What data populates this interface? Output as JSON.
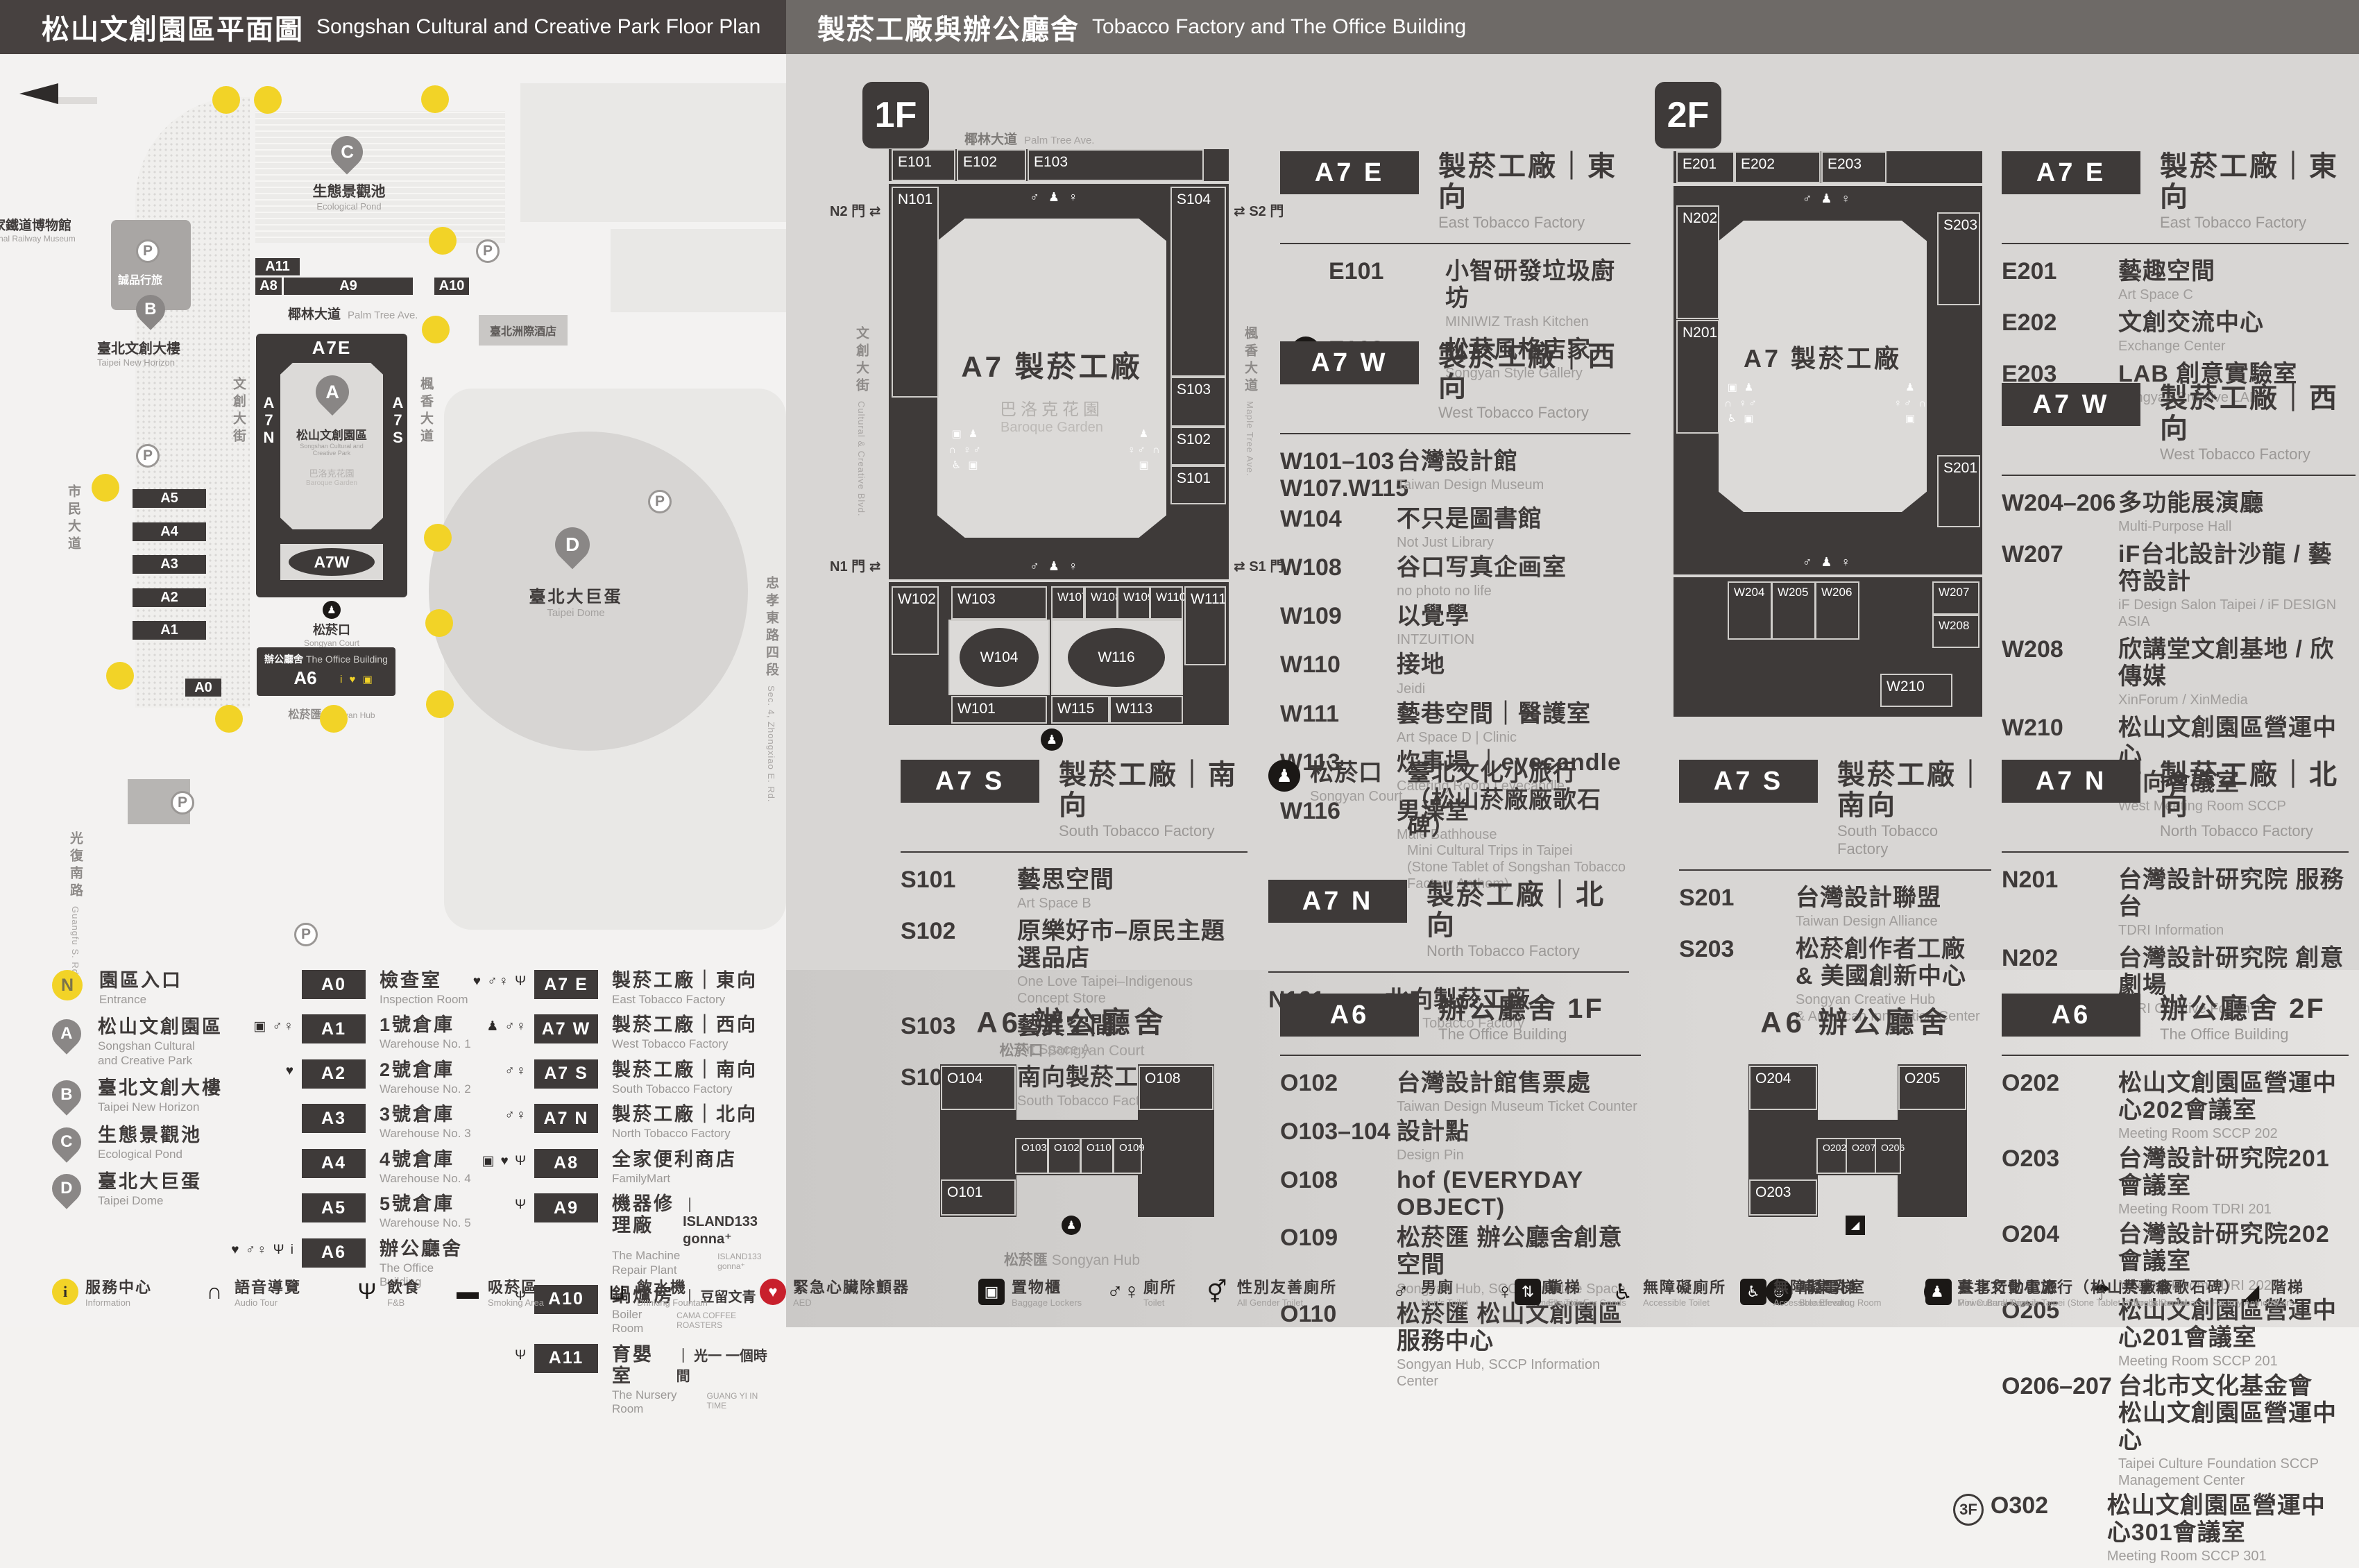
{
  "header": {
    "left_zh": "松山文創園區平面圖",
    "left_en": "Songshan Cultural and Creative Park Floor Plan",
    "right_zh": "製菸工廠與辦公廳舍",
    "right_en": "Tobacco Factory and The Office Building"
  },
  "floors": {
    "f1": "1F",
    "f2": "2F"
  },
  "plans": {
    "a6_title": "A6 辦公廳舍",
    "center_big": "A7 製菸工廠",
    "garden_zh": "巴洛克花園",
    "garden_en": "Baroque Garden",
    "palm_zh": "椰林大道",
    "palm_en": "Palm Tree Ave.",
    "ccblvd_zh": "文創大街",
    "ccblvd_en": "Cultural & Creative Blvd.",
    "maple_zh": "楓香大道",
    "maple_en": "Maple Tree Ave.",
    "court_zh": "松菸口",
    "court_en": "Songyan Court",
    "hub_zh": "松菸匯",
    "hub_en": "Songyan Hub",
    "gate_arrow": "⇄",
    "gate_n2": "N2 門",
    "gate_s2": "S2 門",
    "gate_n1": "N1 門",
    "gate_s1": "S1 門",
    "gate_icons": "♂ ♟ ♀",
    "wing_icons_l": "▣ ♟\n∩ ♀♂\n♿ ▣",
    "wing_icons_r": "♟\n♀♂ ∩\n▣",
    "trips_glyph": "♟",
    "fnb_glyph": "Ψ",
    "locker_glyph": "▣",
    "aed_glyph": "♥",
    "umb_glyph": "☂",
    "f1": [
      "E101",
      "E102",
      "E103",
      "N101",
      "S104",
      "S103",
      "S102",
      "S101",
      "W102",
      "W103",
      "W104",
      "W101",
      "W107",
      "W108",
      "W109",
      "W110",
      "W116",
      "W115",
      "W113",
      "W111"
    ],
    "f2": [
      "E201",
      "E202",
      "E203",
      "N202",
      "N201",
      "S203",
      "S201",
      "W204",
      "W205",
      "W206",
      "W207",
      "W208",
      "W210"
    ],
    "a6f1": [
      "O104",
      "O101",
      "O103",
      "O102",
      "O110",
      "O109",
      "O108"
    ],
    "a6f2": [
      "O204",
      "O203",
      "O202",
      "O207",
      "O206",
      "O205"
    ]
  },
  "dir": {
    "f1_e": {
      "badge": "A7 E",
      "zh": "製菸工廠｜東向",
      "en": "East Tobacco Factory",
      "items": [
        {
          "id": "E101",
          "zh": "小智研發垃圾廚坊",
          "en": "MINIWIZ Trash Kitchen"
        },
        {
          "icon": "Ψ",
          "id": "E103",
          "zh": "松菸風格店家",
          "en": "Songyan Style Gallery"
        }
      ]
    },
    "f1_w": {
      "badge": "A7 W",
      "zh": "製菸工廠｜西向",
      "en": "West Tobacco Factory",
      "items": [
        {
          "id": "W101–103\nW107.W115",
          "zh": "台灣設計館",
          "en": "Taiwan Design Museum"
        },
        {
          "id": "W104",
          "zh": "不只是圖書館",
          "en": "Not Just Library"
        },
        {
          "id": "W108",
          "zh": "谷口写真企画室",
          "en": "no photo no life"
        },
        {
          "id": "W109",
          "zh": "以覺學",
          "en": "INTZUITION"
        },
        {
          "id": "W110",
          "zh": "接地",
          "en": "Jeidi"
        },
        {
          "id": "W111",
          "zh": "藝巷空間｜醫護室",
          "en": "Art Space D | Clinic"
        },
        {
          "id": "W113",
          "zh": "炊事場 ｜eyecandle",
          "en": "Catering Room | eyecandle"
        },
        {
          "id": "W116",
          "zh": "男澡堂",
          "en": "Male Bathhouse"
        }
      ]
    },
    "f1_s": {
      "badge": "A7 S",
      "zh": "製菸工廠｜南向",
      "en": "South Tobacco Factory",
      "items": [
        {
          "id": "S101",
          "zh": "藝思空間",
          "en": "Art Space B"
        },
        {
          "id": "S102",
          "zh": "原樂好市–原民主題選品店",
          "en": "One Love Taipei–Indigenous Concept Store"
        },
        {
          "id": "S103",
          "zh": "藝異空間",
          "en": "Art Space A"
        },
        {
          "id": "S104",
          "zh": "南向製菸工廠",
          "en": "South Tobacco Factory"
        }
      ]
    },
    "court": {
      "icon": "♟",
      "zh": "松菸口",
      "en": "Songyan Court",
      "item_zh": "臺北文化小旅行\n（松山菸廠廠歌石碑）",
      "item_en": "Mini Cultural Trips in Taipei\n(Stone Tablet of Songshan Tobacco Factory Anthem)"
    },
    "f1_n": {
      "badge": "A7 N",
      "zh": "製菸工廠｜北向",
      "en": "North Tobacco Factory",
      "items": [
        {
          "id": "N101",
          "zh": "北向製菸工廠",
          "en": "North Tobacco Factory"
        }
      ]
    },
    "f1_a6": {
      "badge": "A6",
      "zh": "辦公廳舍 1F",
      "en": "The Office Building",
      "items": [
        {
          "id": "O102",
          "zh": "台灣設計館售票處",
          "en": "Taiwan Design Museum Ticket Counter"
        },
        {
          "id": "O103–104",
          "zh": "設計點",
          "en": "Design Pin"
        },
        {
          "id": "O108",
          "zh": "hof (EVERYDAY OBJECT)",
          "en": ""
        },
        {
          "id": "O109",
          "zh": "松菸匯 辦公廳舍創意空間",
          "en": "Songyan Hub, SCCP Creative Space"
        },
        {
          "id": "O110",
          "zh": "松菸匯 松山文創園區服務中心",
          "en": "Songyan Hub, SCCP Information Center"
        }
      ]
    },
    "f2_e": {
      "badge": "A7 E",
      "zh": "製菸工廠｜東向",
      "en": "East Tobacco Factory",
      "items": [
        {
          "id": "E201",
          "zh": "藝趣空間",
          "en": "Art Space C"
        },
        {
          "id": "E202",
          "zh": "文創交流中心",
          "en": "Exchange Center"
        },
        {
          "id": "E203",
          "zh": "LAB 創意實驗室",
          "en": "Songyan Creative LAB"
        }
      ]
    },
    "f2_w": {
      "badge": "A7 W",
      "zh": "製菸工廠｜西向",
      "en": "West Tobacco Factory",
      "items": [
        {
          "id": "W204–206",
          "zh": "多功能展演廳",
          "en": "Multi-Purpose Hall"
        },
        {
          "id": "W207",
          "zh": "iF台北設計沙龍 / 藝符設計",
          "en": "iF Design Salon Taipei / iF DESIGN ASIA"
        },
        {
          "id": "W208",
          "zh": "欣講堂文創基地 / 欣傳媒",
          "en": "XinForum / XinMedia"
        },
        {
          "id": "W210",
          "zh": "松山文創園區營運中心\n西向會議室",
          "en": "West Meeting Room SCCP"
        }
      ]
    },
    "f2_s": {
      "badge": "A7 S",
      "zh": "製菸工廠｜南向",
      "en": "South Tobacco Factory",
      "items": [
        {
          "id": "S201",
          "zh": "台灣設計聯盟",
          "en": "Taiwan Design Alliance"
        },
        {
          "id": "S203",
          "zh": "松菸創作者工廠\n& 美國創新中心",
          "en": "Songyan Creative Hub\n& American Innovation Center"
        }
      ]
    },
    "f2_n": {
      "badge": "A7 N",
      "zh": "製菸工廠｜北向",
      "en": "North Tobacco Factory",
      "items": [
        {
          "id": "N201",
          "zh": "台灣設計研究院 服務台",
          "en": "TDRI Information"
        },
        {
          "id": "N202",
          "zh": "台灣設計研究院 創意劇場",
          "en": "TDRI Creative Forum"
        }
      ]
    },
    "f2_a6": {
      "badge": "A6",
      "zh": "辦公廳舍 2F",
      "en": "The Office Building",
      "items": [
        {
          "id": "O202",
          "zh": "松山文創園區營運中心202會議室",
          "en": "Meeting Room SCCP 202"
        },
        {
          "id": "O203",
          "zh": "台灣設計研究院201會議室",
          "en": "Meeting Room TDRI 201"
        },
        {
          "id": "O204",
          "zh": "台灣設計研究院202會議室",
          "en": "Meeting Room TDRI 202"
        },
        {
          "id": "O205",
          "zh": "松山文創園區營運中心201會議室",
          "en": "Meeting Room SCCP 201"
        },
        {
          "id": "O206–207",
          "zh": "台北市文化基金會\n松山文創園區營運中心",
          "en": "Taipei Culture Foundation SCCP Management Center"
        },
        {
          "prefix": "3F",
          "id": "O302",
          "zh": "松山文創園區營運中心301會議室",
          "en": "Meeting Room SCCP 301"
        }
      ]
    }
  },
  "map": {
    "p": "P",
    "pins": {
      "a": "A",
      "b": "B",
      "c": "C",
      "d": "D"
    },
    "entrances": [
      {
        "n": "1"
      },
      {
        "n": "2"
      },
      {
        "n": "3"
      },
      {
        "n": "4"
      },
      {
        "n": "5"
      },
      {
        "n": "6"
      },
      {
        "n": "7"
      },
      {
        "n": "8"
      },
      {
        "n": "9"
      },
      {
        "n": "10"
      },
      {
        "n": "11"
      },
      {
        "n": "12"
      }
    ],
    "railway_zh": "國家鐵道博物館",
    "railway_en": "National Railway Museum",
    "pond_zh": "生態景觀池",
    "pond_en": "Ecological Pond",
    "horizon_zh": "臺北文創大樓",
    "horizon_en": "Taipei New Horizon",
    "eslite": "誠品行旅",
    "park_zh": "松山文創園區",
    "park_en": "Songshan Cultural and\nCreative Park",
    "garden_zh": "巴洛克花園",
    "garden_en": "Baroque Garden",
    "dome_zh": "臺北大巨蛋",
    "dome_en": "Taipei Dome",
    "intercont": "臺北洲際酒店",
    "court_zh": "松菸口",
    "court_en": "Songyan Court",
    "office_zh": "辦公廳舍",
    "office_en": "The Office Building",
    "hub_zh": "松菸匯",
    "hub_en": "Songyan Hub",
    "palm_zh": "椰林大道",
    "palm_en": "Palm Tree Ave.",
    "ccblvd_zh": "文創大街",
    "maple_zh": "楓香大道",
    "zhongxiao_zh": "忠孝東路四段",
    "zhongxiao_en": "Sec. 4, Zhongxiao E. Rd.",
    "civic_zh": "市民大道",
    "guangfu_zh": "光復南路",
    "guangfu_en": "Guangfu S. Rd.",
    "a7e": "A7E",
    "a7n": "A7N",
    "a7s": "A7S",
    "a7w": "A7W",
    "a6": "A6",
    "a0": "A0",
    "a1": "A1",
    "a2": "A2",
    "a3": "A3",
    "a4": "A4",
    "a5": "A5",
    "a8": "A8",
    "a9": "A9",
    "a10": "A10",
    "a11": "A11",
    "a6_icons": "i ♥ ▣"
  },
  "legend": {
    "col1": [
      {
        "cls": "nmk",
        "mark": "N",
        "zh": "園區入口",
        "en": "Entrance"
      },
      {
        "cls": "pinmk",
        "mark": "A",
        "zh": "松山文創園區",
        "en": "Songshan Cultural\nand Creative Park"
      },
      {
        "cls": "pinmk",
        "mark": "B",
        "zh": "臺北文創大樓",
        "en": "Taipei New Horizon"
      },
      {
        "cls": "pinmk",
        "mark": "C",
        "zh": "生態景觀池",
        "en": "Ecological Pond"
      },
      {
        "cls": "pinmk",
        "mark": "D",
        "zh": "臺北大巨蛋",
        "en": "Taipei Dome"
      }
    ],
    "col2": [
      {
        "icons": "",
        "badge": "A0",
        "zh": "檢查室",
        "en": "Inspection Room"
      },
      {
        "icons": "▣ ♂♀",
        "badge": "A1",
        "zh": "1號倉庫",
        "en": "Warehouse No. 1"
      },
      {
        "icons": "♥",
        "badge": "A2",
        "zh": "2號倉庫",
        "en": "Warehouse No. 2"
      },
      {
        "icons": "",
        "badge": "A3",
        "zh": "3號倉庫",
        "en": "Warehouse No. 3"
      },
      {
        "icons": "",
        "badge": "A4",
        "zh": "4號倉庫",
        "en": "Warehouse No. 4"
      },
      {
        "icons": "",
        "badge": "A5",
        "zh": "5號倉庫",
        "en": "Warehouse No. 5"
      },
      {
        "icons": "♥ ♂♀ Ψ i",
        "badge": "A6",
        "zh": "辦公廳舍",
        "en": "The Office Building"
      }
    ],
    "col3": [
      {
        "icons": "♥ ♂♀ Ψ",
        "badge": "A7 E",
        "zh": "製菸工廠｜東向",
        "en": "East Tobacco Factory"
      },
      {
        "icons": "♟ ♂♀",
        "badge": "A7 W",
        "zh": "製菸工廠｜西向",
        "en": "West Tobacco Factory"
      },
      {
        "icons": "♂♀",
        "badge": "A7 S",
        "zh": "製菸工廠｜南向",
        "en": "South Tobacco Factory"
      },
      {
        "icons": "♂♀",
        "badge": "A7 N",
        "zh": "製菸工廠｜北向",
        "en": "North Tobacco Factory"
      },
      {
        "icons": "▣ ♥ Ψ",
        "badge": "A8",
        "zh": "全家便利商店",
        "en": "FamilyMart"
      },
      {
        "icons": "Ψ",
        "badge": "A9",
        "zh": "機器修理廠",
        "en": "The Machine Repair Plant",
        "side": "｜ ISLAND133 gonna⁺",
        "side_en": "ISLAND133 gonna⁺"
      },
      {
        "icons": "Ψ",
        "badge": "A10",
        "zh": "鍋爐房",
        "en": "Boiler Room",
        "side": "｜ 豆留文青",
        "side_en": "CAMA COFFEE ROASTERS"
      },
      {
        "icons": "Ψ",
        "badge": "A11",
        "zh": "育嬰室",
        "en": "The Nursery Room",
        "side": "｜ 光一 一個時間",
        "side_en": "GUANG YI IN TIME"
      }
    ]
  },
  "strip": [
    {
      "cls": "y",
      "g": "i",
      "zh": "服務中心",
      "en": "Information"
    },
    {
      "cls": "p",
      "g": "∩",
      "zh": "語音導覽",
      "en": "Audio Tour"
    },
    {
      "cls": "p",
      "g": "Ψ",
      "zh": "飲食",
      "en": "F&B"
    },
    {
      "cls": "p",
      "g": "▬",
      "zh": "吸菸區",
      "en": "Smoking Area"
    },
    {
      "cls": "p",
      "g": "⊔",
      "zh": "飲水機",
      "en": "Drinking Fountain"
    },
    {
      "cls": "r",
      "g": "♥",
      "zh": "緊急心臟除顫器",
      "en": "AED"
    },
    {
      "cls": "q",
      "g": "▣",
      "zh": "置物櫃",
      "en": "Baggage Lockers"
    },
    {
      "cls": "p",
      "g": "♂♀",
      "zh": "廁所",
      "en": "Toilet"
    },
    {
      "cls": "p",
      "g": "⚥",
      "zh": "性別友善廁所",
      "en": "All Gender Toilet"
    },
    {
      "cls": "p",
      "g": "♂",
      "zh": "男廁",
      "en": "Men's Toilet"
    },
    {
      "cls": "p",
      "g": "♀",
      "zh": "女廁",
      "en": "Women's Toilet"
    },
    {
      "cls": "p",
      "g": "♿",
      "zh": "無障礙廁所",
      "en": "Accessible Toilet"
    },
    {
      "cls": "c",
      "g": "☺",
      "zh": "哺集乳室",
      "en": "Breastfeeding Room"
    },
    {
      "cls": "q",
      "g": "ϟ",
      "zh": "共享行動電源",
      "en": "Power Bank Rental"
    },
    {
      "cls": "p",
      "g": "☂",
      "zh": "共享傘",
      "en": "Umbrella Rental"
    },
    {
      "cls": "p",
      "g": "◢",
      "zh": "階梯",
      "en": "Stairs"
    }
  ],
  "strip2": [
    {
      "cls": "q",
      "g": "⇅",
      "zh": "貨梯",
      "en": "Elevator For Goods"
    },
    {
      "cls": "q",
      "g": "♿",
      "zh": "無障礙電梯",
      "en": "Accessible Elevator"
    },
    {
      "cls": "c",
      "g": "♟",
      "zh": "臺北文化小旅行（松山菸廠廠歌石碑）",
      "en": "Mini Cultural Trips in Taipei (Stone Tablet of Songshan Tobacco Factory Anthem)"
    }
  ]
}
